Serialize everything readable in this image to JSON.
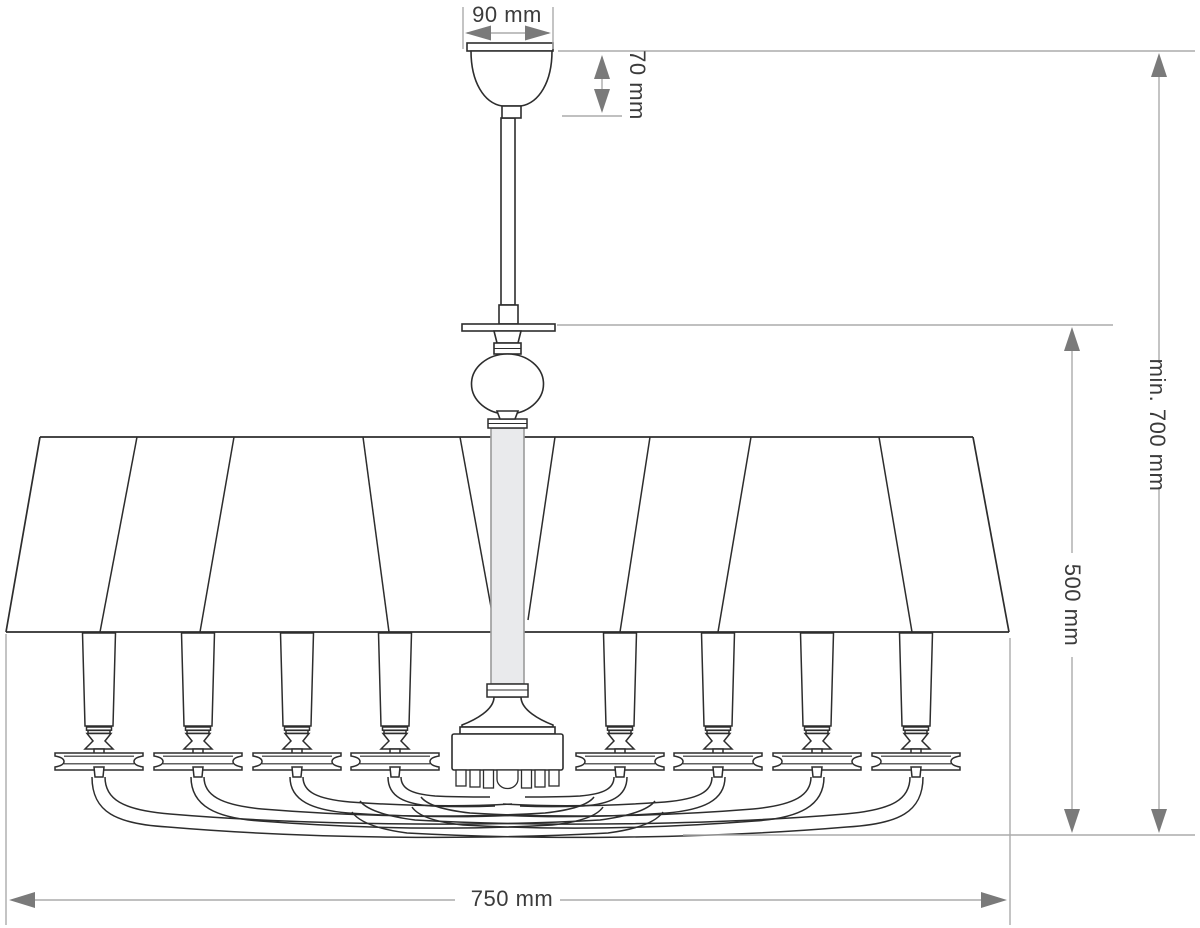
{
  "drawing": {
    "subject": "chandelier-technical-dimension-drawing",
    "labels": {
      "canopy_width": "90 mm",
      "canopy_height": "70 mm",
      "min_drop": "min. 700 mm",
      "body_height": "500 mm",
      "diameter": "750 mm"
    },
    "colors": {
      "outline": "#2d2d2d",
      "dimension_line": "#ababab",
      "arrow": "#7a7a7a",
      "column_fill": "#e9eaec",
      "text": "#3b3b3b",
      "background": "#ffffff"
    }
  }
}
